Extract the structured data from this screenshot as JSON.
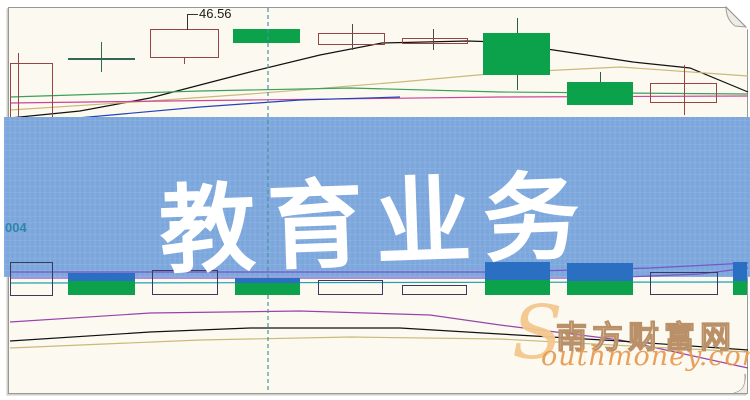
{
  "banner": {
    "title": "教育业务",
    "bg_color": "#7CA7DC",
    "text_color": "#FFFFFF"
  },
  "left_axis_label": "004",
  "watermark": {
    "initial": "S",
    "cn_text": "南方财富网",
    "en_text": "outhmoney.com",
    "accent_color": "#E89950"
  },
  "chart_data": {
    "type": "candlestick",
    "price_label": "46.56",
    "colors": {
      "up_fill": "#0CA24B",
      "hollow_border": "#964444",
      "doji": "#336655",
      "vol_hollow_border": "#3A3A5C",
      "vol_blue": "#2B6FC2",
      "banner": "#7CA7DC"
    },
    "candles": [
      {
        "x": 10,
        "w": 43,
        "top": 63,
        "bottom": 127,
        "style": "hollow",
        "wick_x": 18,
        "wick_top": 53,
        "wick_bottom": 133,
        "wick_color": "#964444"
      },
      {
        "x": 68,
        "w": 67,
        "top": 58,
        "bottom": 60,
        "style": "doji",
        "wick_x": 101,
        "wick_top": 42,
        "wick_bottom": 72,
        "wick_color": "#336655"
      },
      {
        "x": 150,
        "w": 69,
        "top": 29,
        "bottom": 58,
        "style": "hollow",
        "wick_x": 184,
        "wick_top": 58,
        "wick_bottom": 64,
        "wick_color": "#964444"
      },
      {
        "x": 233,
        "w": 67,
        "top": 29,
        "bottom": 43,
        "style": "fill"
      },
      {
        "x": 318,
        "w": 67,
        "top": 33,
        "bottom": 45,
        "style": "hollow",
        "wick_x": 352,
        "wick_top": 24,
        "wick_bottom": 50,
        "wick_color": "#4A4A4A"
      },
      {
        "x": 402,
        "w": 66,
        "top": 38,
        "bottom": 44,
        "style": "hollow",
        "wick_x": 433,
        "wick_top": 29,
        "wick_bottom": 50,
        "wick_color": "#4A4A4A"
      },
      {
        "x": 483,
        "w": 67,
        "top": 33,
        "bottom": 75,
        "style": "fill",
        "wick_x": 517,
        "wick_top": 18,
        "wick_bottom": 90,
        "wick_color": "#2F5D3A"
      },
      {
        "x": 567,
        "w": 66,
        "top": 82,
        "bottom": 105,
        "style": "fill",
        "wick_x": 600,
        "wick_top": 72,
        "wick_bottom": 105,
        "wick_color": "#2F5D3A"
      },
      {
        "x": 650,
        "w": 67,
        "top": 83,
        "bottom": 103,
        "style": "hollow",
        "wick_x": 684,
        "wick_top": 65,
        "wick_bottom": 115,
        "wick_color": "#964444"
      }
    ],
    "volume_bars": [
      {
        "x": 10,
        "w": 43,
        "top": 262,
        "bottom": 296,
        "style": "hollow"
      },
      {
        "x": 68,
        "w": 67,
        "top": 273,
        "blue_to": 281,
        "bottom": 295,
        "style": "fill"
      },
      {
        "x": 152,
        "w": 66,
        "top": 270,
        "bottom": 295,
        "style": "hollow"
      },
      {
        "x": 235,
        "w": 65,
        "top": 278,
        "blue_to": 283,
        "bottom": 295,
        "style": "fill"
      },
      {
        "x": 318,
        "w": 65,
        "top": 280,
        "bottom": 295,
        "style": "hollow"
      },
      {
        "x": 402,
        "w": 65,
        "top": 285,
        "bottom": 295,
        "style": "hollow"
      },
      {
        "x": 485,
        "w": 65,
        "top": 262,
        "blue_to": 280,
        "bottom": 295,
        "style": "fill"
      },
      {
        "x": 567,
        "w": 66,
        "top": 263,
        "blue_to": 281,
        "bottom": 295,
        "style": "fill"
      },
      {
        "x": 650,
        "w": 68,
        "top": 272,
        "bottom": 295,
        "style": "hollow"
      },
      {
        "x": 733,
        "w": 14,
        "top": 262,
        "blue_to": 281,
        "bottom": 295,
        "style": "fill"
      }
    ],
    "lines": {
      "upper": [
        {
          "color": "#111111",
          "points": [
            [
              10,
              118
            ],
            [
              80,
              111
            ],
            [
              150,
              98
            ],
            [
              250,
              72
            ],
            [
              320,
              55
            ],
            [
              382,
              43
            ],
            [
              467,
              41
            ],
            [
              500,
              42
            ],
            [
              567,
              52
            ],
            [
              633,
              62
            ],
            [
              690,
              68
            ],
            [
              748,
              92
            ]
          ]
        },
        {
          "color": "#C9B97A",
          "points": [
            [
              10,
              110
            ],
            [
              150,
              101
            ],
            [
              250,
              94
            ],
            [
              400,
              82
            ],
            [
              500,
              73
            ],
            [
              620,
              67
            ],
            [
              748,
              76
            ]
          ]
        },
        {
          "color": "#3AA05A",
          "points": [
            [
              10,
              97
            ],
            [
              200,
              91
            ],
            [
              350,
              88
            ],
            [
              500,
              92
            ],
            [
              748,
              94
            ]
          ]
        },
        {
          "color": "#CC4499",
          "points": [
            [
              10,
              103
            ],
            [
              250,
              100
            ],
            [
              500,
              97
            ],
            [
              748,
              96
            ]
          ]
        },
        {
          "color": "#2244BB",
          "points": [
            [
              10,
              124
            ],
            [
              100,
              116
            ],
            [
              200,
              107
            ],
            [
              300,
              100
            ],
            [
              400,
              97
            ]
          ]
        }
      ],
      "volume_ma": [
        {
          "color": "#7755CC",
          "points": [
            [
              10,
              272
            ],
            [
              500,
              272
            ],
            [
              650,
              268
            ],
            [
              748,
              263
            ]
          ]
        },
        {
          "color": "#7755CC",
          "points": [
            [
              10,
              278
            ],
            [
              600,
              278
            ],
            [
              700,
              274
            ],
            [
              748,
              268
            ]
          ]
        },
        {
          "color": "#22A0B0",
          "points": [
            [
              10,
              283
            ],
            [
              748,
              282
            ]
          ]
        }
      ],
      "lower": [
        {
          "color": "#9944AA",
          "points": [
            [
              10,
              322
            ],
            [
              150,
              313
            ],
            [
              300,
              311
            ],
            [
              430,
              315
            ],
            [
              500,
              325
            ],
            [
              620,
              340
            ],
            [
              748,
              368
            ]
          ]
        },
        {
          "color": "#111111",
          "points": [
            [
              10,
              341
            ],
            [
              150,
              332
            ],
            [
              250,
              328
            ],
            [
              400,
              328
            ],
            [
              500,
              334
            ],
            [
              620,
              341
            ],
            [
              748,
              350
            ]
          ]
        },
        {
          "color": "#C9B97A",
          "points": [
            [
              10,
              348
            ],
            [
              200,
              340
            ],
            [
              350,
              337
            ],
            [
              500,
              339
            ],
            [
              650,
              347
            ],
            [
              748,
              352
            ]
          ]
        }
      ]
    },
    "dashed_vline_x": 268
  }
}
